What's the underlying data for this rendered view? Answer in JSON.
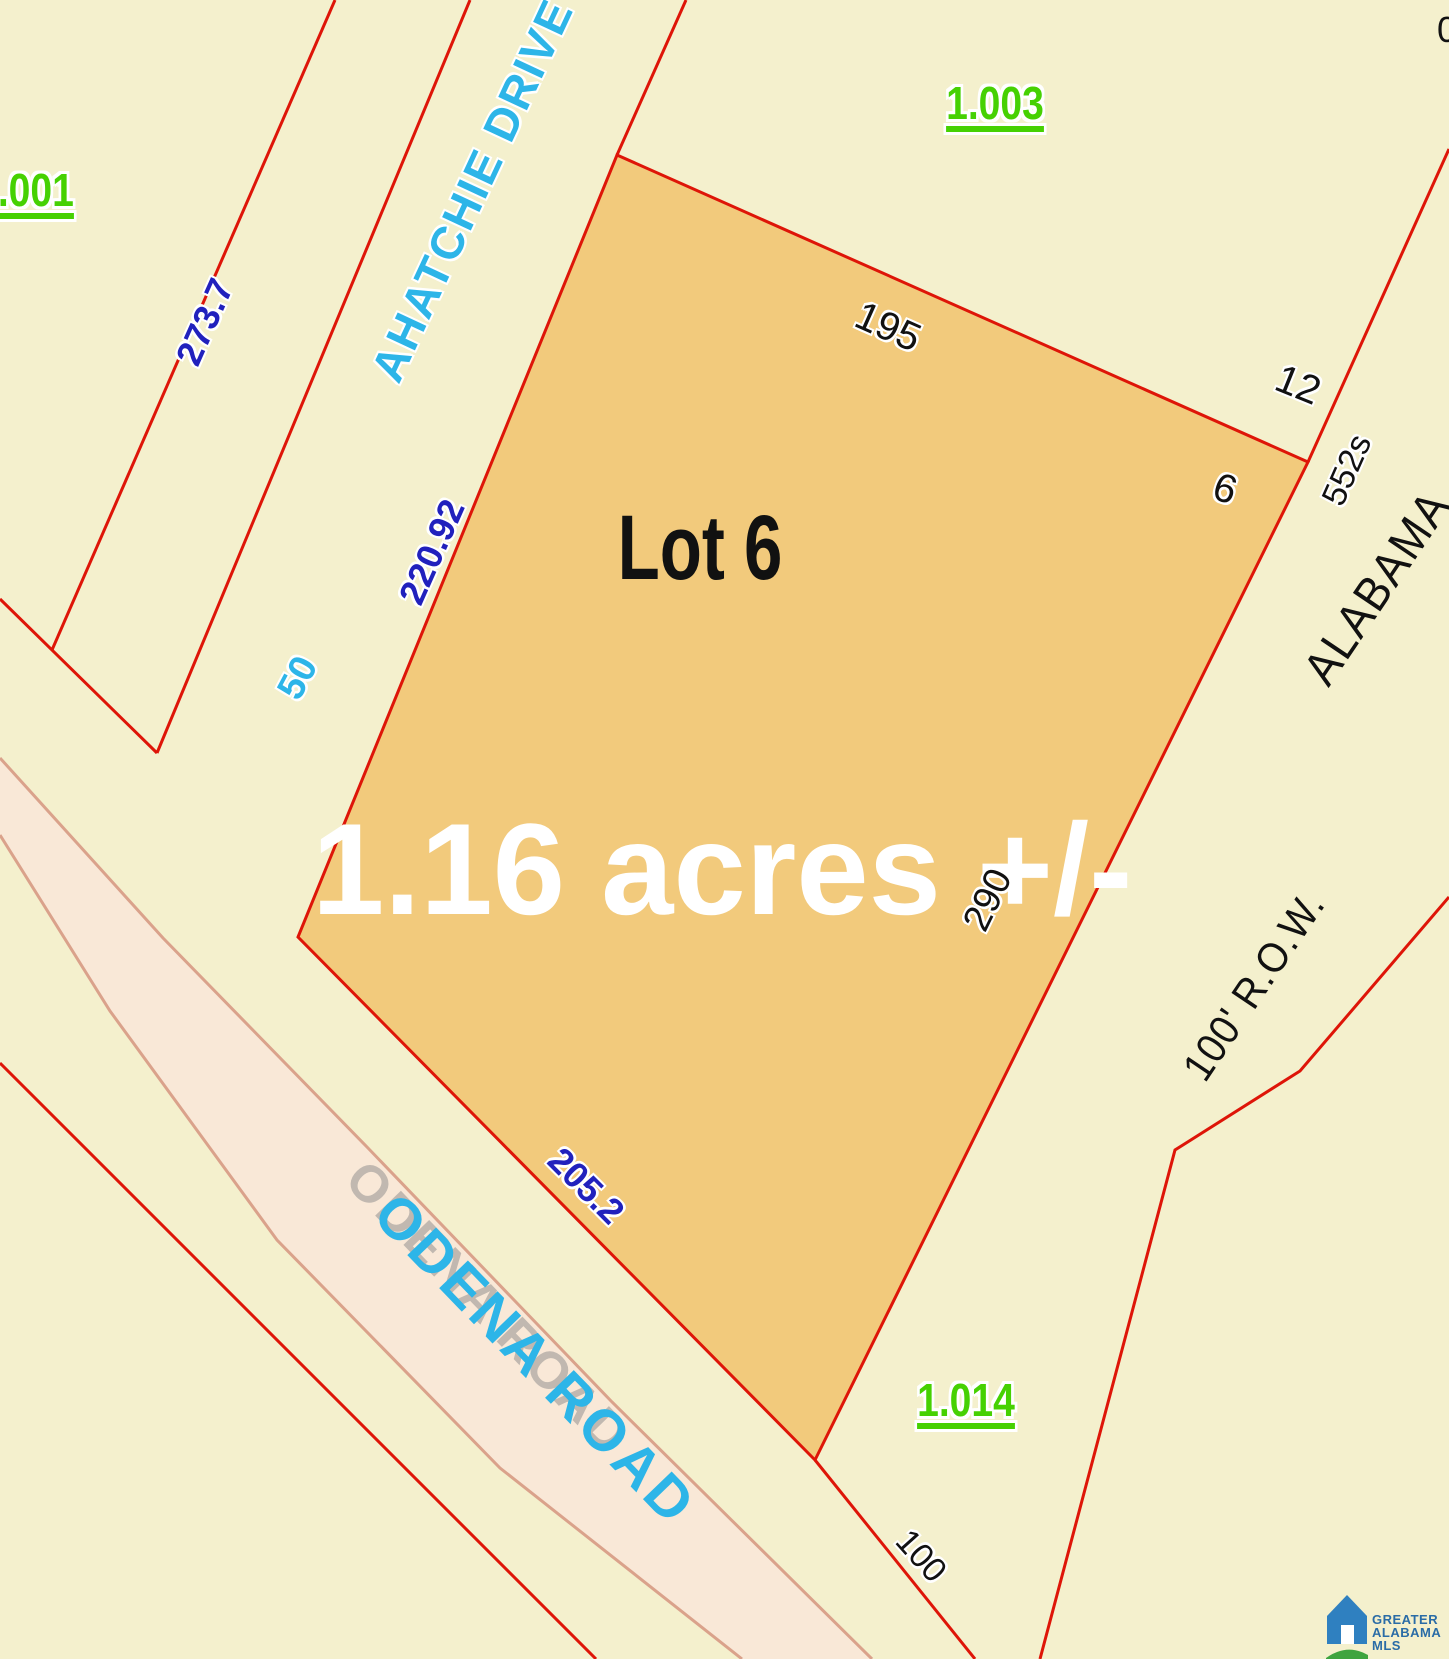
{
  "labels": {
    "parcel_1001": "1.001",
    "parcel_1003": "1.003",
    "parcel_1014": "1.014",
    "street_ahatchie": "AHATCHIE DRIVE",
    "street_odena": "ODENA ROAD",
    "street_odena_ghost": "ODENA ROAD",
    "highway": "ALABAMA",
    "row": "100' R.O.W.",
    "lot_title": "Lot 6",
    "area": "1.16 acres +/-",
    "dim_273_7": "273.7",
    "dim_220_92": "220.92",
    "dim_50": "50",
    "dim_195": "195",
    "dim_12": "12",
    "dim_6": "6",
    "dim_552s": "552s",
    "dim_290": "290",
    "dim_205_2": "205.2",
    "dim_100": "100",
    "edge_partial": "0"
  },
  "logo": {
    "line1": "GREATER",
    "line2": "ALABAMA",
    "line3": "MLS"
  },
  "colors": {
    "red": "#de1508",
    "green": "#46d102",
    "cyan": "#2db5e8",
    "blue": "#2121bd",
    "black": "#111111",
    "white": "#ffffff",
    "lot_fill": "#f2ca7c",
    "bg": "#f4f0cd",
    "road_fill": "#f9e8d7",
    "road_edge": "#daa28b",
    "ghost": "#8a8a8a",
    "logo_blue": "#2a6ca6",
    "logo_house": "#2f80c0",
    "logo_green": "#3fa43f"
  }
}
